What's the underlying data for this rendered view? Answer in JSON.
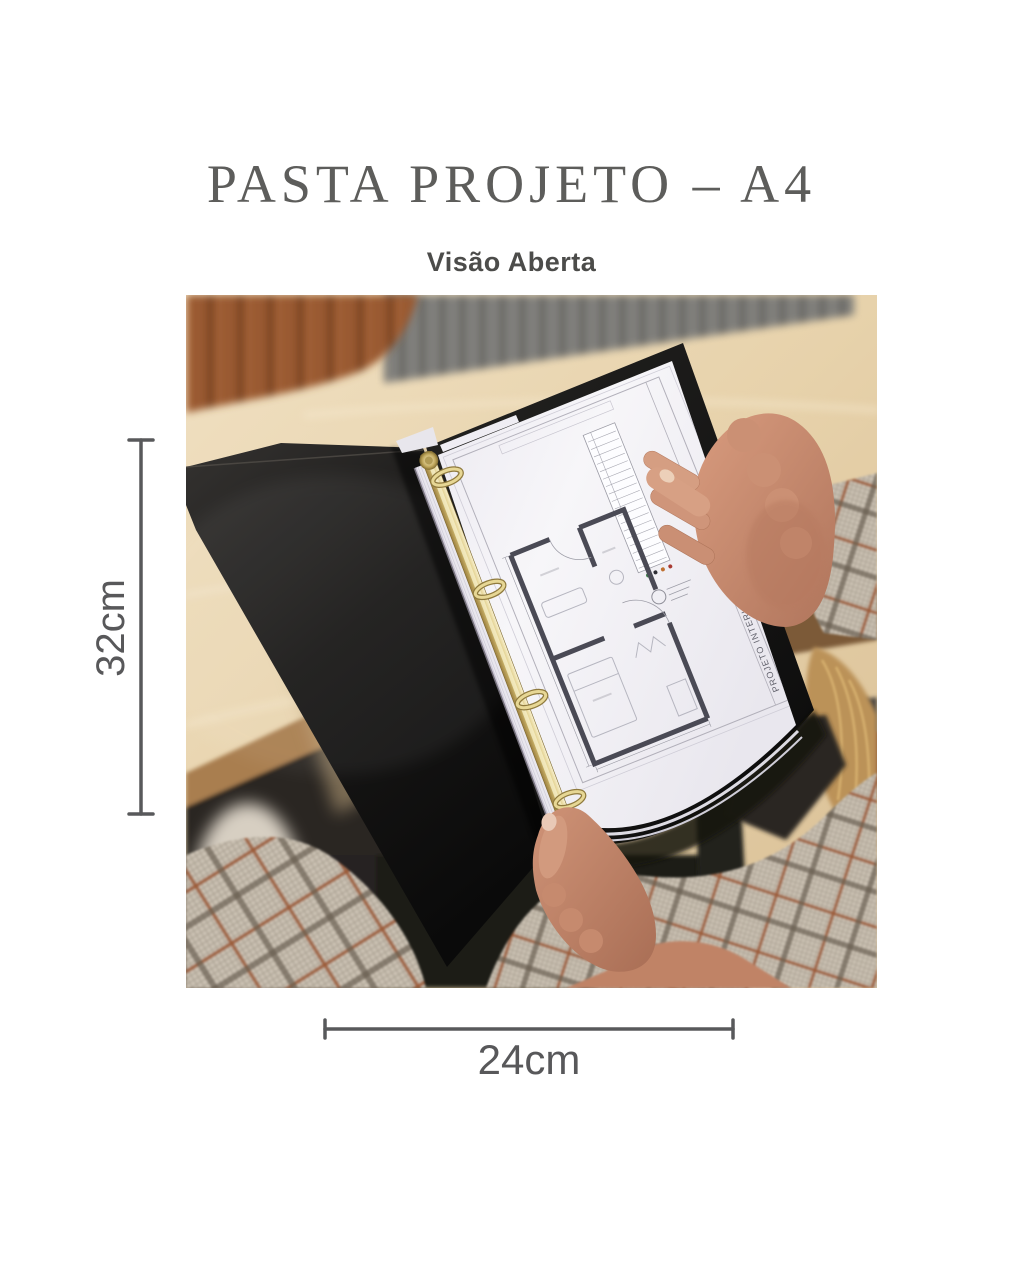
{
  "title": {
    "text": "PASTA PROJETO – A4",
    "color": "#5d5d5b"
  },
  "subtitle": {
    "text": "Visão Aberta",
    "color": "#4c4c4a"
  },
  "dimensions": {
    "height_label": "32cm",
    "width_label": "24cm",
    "line_color": "#58595b"
  },
  "photo": {
    "description": "Open black A4 project binder with gold four-ring mechanism holding an architectural floor-plan sheet, held in two hands over a light wooden desk",
    "document_vertical_text": "PROJETO INTERIORES RESIDENCIAL",
    "colors": {
      "binder_cover": "#151413",
      "ring_gold": "#d9c478",
      "paper": "#f5f4f7",
      "plan_walls": "#4a4a55",
      "desk_wood": "#e7d3ae",
      "chair_leather": "#9a5a31",
      "blazer_plaid": "#ccc2b4",
      "skin": "#c98e72",
      "hair": "#bb9258"
    }
  }
}
